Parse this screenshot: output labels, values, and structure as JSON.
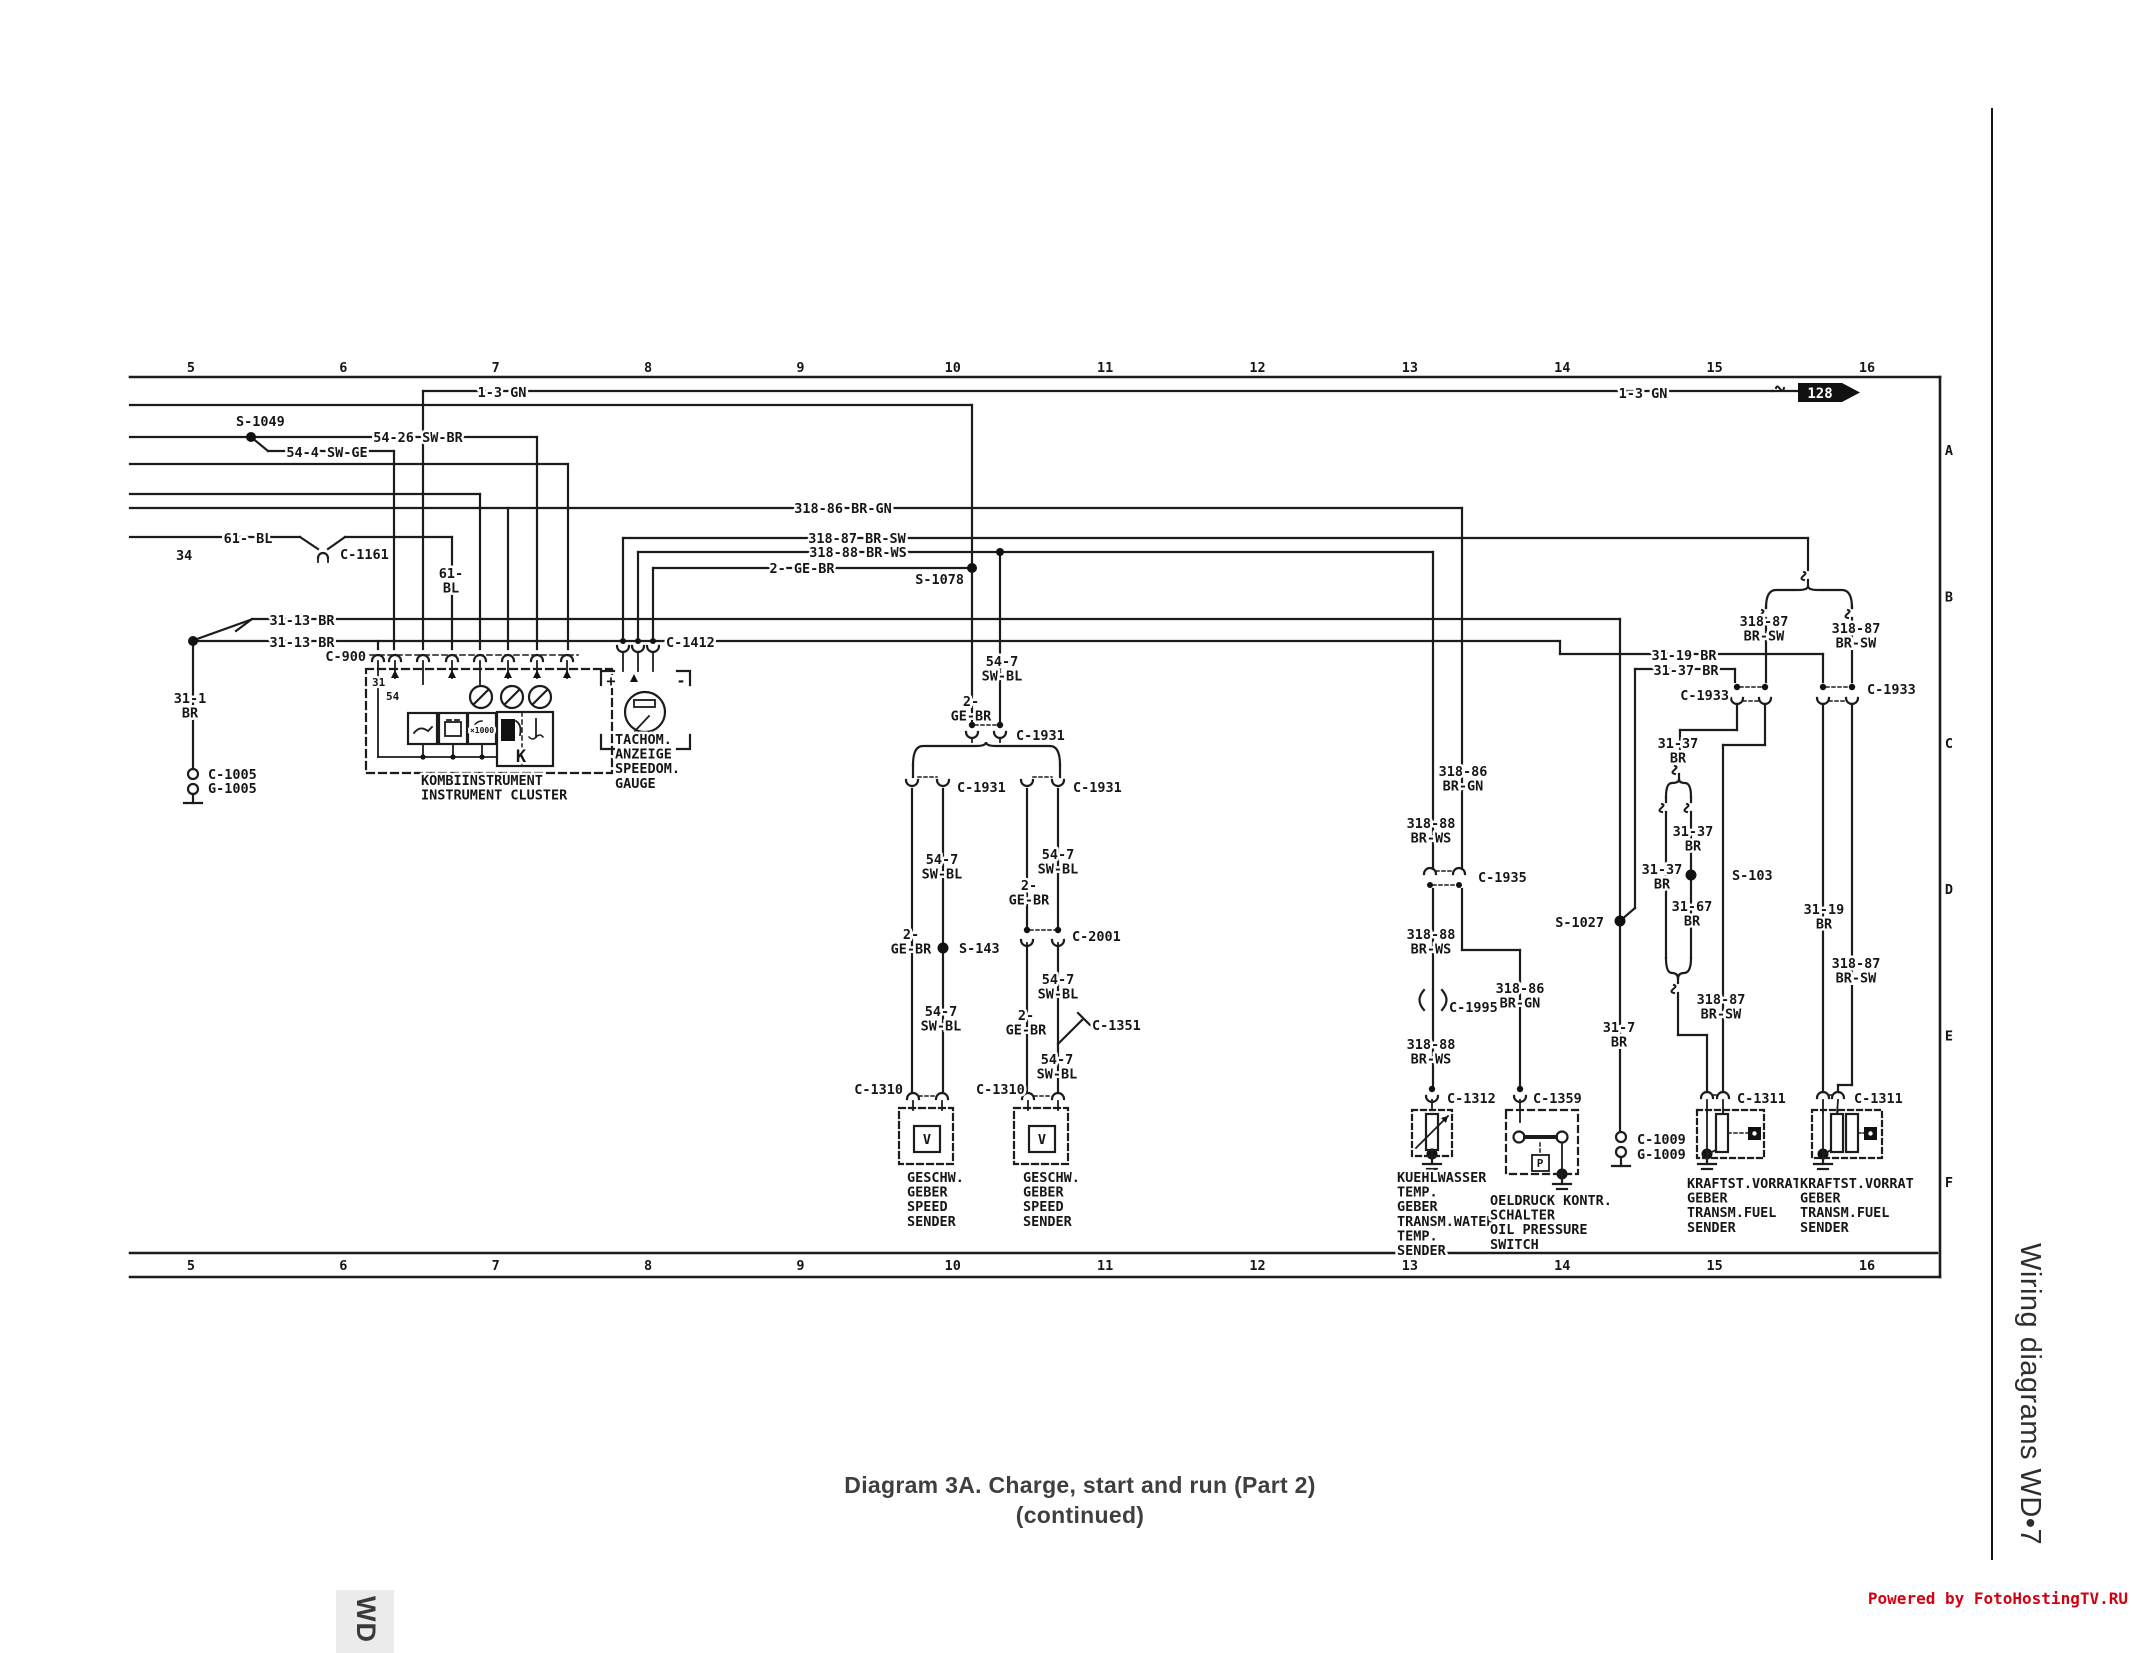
{
  "page": {
    "title_line1": "Diagram 3A. Charge, start and run (Part 2)",
    "title_line2": "(continued)",
    "sidebar_title": "Wiring diagrams  WD•7",
    "footer": "Powered by FotoHostingTV.RU",
    "corner_tab": "WD"
  },
  "ruler": {
    "numbers": [
      "5",
      "6",
      "7",
      "8",
      "9",
      "10",
      "11",
      "12",
      "13",
      "14",
      "15",
      "16"
    ],
    "letters": [
      "A",
      "B",
      "C",
      "D",
      "E",
      "F"
    ]
  },
  "diagram": {
    "arrow_ref": "128",
    "labels": [
      {
        "t": "S-1049",
        "x": 236,
        "y": 426,
        "a": "s"
      },
      {
        "t": "54-26 SW-BR",
        "x": 418,
        "y": 442,
        "a": "m"
      },
      {
        "t": "54-4 SW-GE",
        "x": 327,
        "y": 457,
        "a": "m"
      },
      {
        "t": "1-3 GN",
        "x": 502,
        "y": 397,
        "a": "m"
      },
      {
        "t": "1-3 GN",
        "x": 1643,
        "y": 398,
        "a": "m"
      },
      {
        "t": "61- BL",
        "x": 248,
        "y": 543,
        "a": "m"
      },
      {
        "t": "34",
        "x": 176,
        "y": 560,
        "a": "s"
      },
      {
        "t": "C-1161",
        "x": 340,
        "y": 559,
        "a": "s"
      },
      {
        "t": "61-\nBL",
        "x": 451,
        "y": 578,
        "a": "m"
      },
      {
        "t": "31-13 BR",
        "x": 302,
        "y": 625,
        "a": "m"
      },
      {
        "t": "31-13 BR",
        "x": 302,
        "y": 647,
        "a": "m"
      },
      {
        "t": "C-900",
        "x": 366,
        "y": 661,
        "a": "e"
      },
      {
        "t": "31",
        "x": 372,
        "y": 686,
        "a": "s",
        "fs": 11
      },
      {
        "t": "54",
        "x": 386,
        "y": 700,
        "a": "s",
        "fs": 11
      },
      {
        "t": "31-1\nBR",
        "x": 190,
        "y": 703,
        "a": "m"
      },
      {
        "t": "C-1005",
        "x": 208,
        "y": 779,
        "a": "s"
      },
      {
        "t": "G-1005",
        "x": 208,
        "y": 793,
        "a": "s"
      },
      {
        "t": "K",
        "x": 521,
        "y": 762,
        "a": "m",
        "fs": 17
      },
      {
        "t": "KOMBIINSTRUMENT\nINSTRUMENT CLUSTER",
        "x": 421,
        "y": 785,
        "a": "s"
      },
      {
        "t": "C-1412",
        "x": 666,
        "y": 647,
        "a": "s"
      },
      {
        "t": "+",
        "x": 611,
        "y": 686,
        "a": "m",
        "fs": 15
      },
      {
        "t": "-",
        "x": 681,
        "y": 686,
        "a": "m",
        "fs": 15
      },
      {
        "t": "TACHOM.\nANZEIGE\nSPEEDOM.\nGAUGE",
        "x": 615,
        "y": 744,
        "a": "s"
      },
      {
        "t": "×1000",
        "x": 482,
        "y": 733,
        "a": "m",
        "fs": 8
      },
      {
        "t": "318-86 BR-GN",
        "x": 843,
        "y": 513,
        "a": "m"
      },
      {
        "t": "318-87 BR-SW",
        "x": 857,
        "y": 543,
        "a": "m"
      },
      {
        "t": "318-88 BR-WS",
        "x": 858,
        "y": 557,
        "a": "m"
      },
      {
        "t": "2- GE-BR",
        "x": 802,
        "y": 573,
        "a": "m"
      },
      {
        "t": "S-1078",
        "x": 964,
        "y": 584,
        "a": "e"
      },
      {
        "t": "54-7\nSW-BL",
        "x": 1002,
        "y": 666,
        "a": "m"
      },
      {
        "t": "2-\nGE-BR",
        "x": 971,
        "y": 706,
        "a": "m"
      },
      {
        "t": "C-1931",
        "x": 1016,
        "y": 740,
        "a": "s"
      },
      {
        "t": "C-1931",
        "x": 957,
        "y": 792,
        "a": "s"
      },
      {
        "t": "C-1931",
        "x": 1073,
        "y": 792,
        "a": "s"
      },
      {
        "t": "54-7\nSW-BL",
        "x": 942,
        "y": 864,
        "a": "m"
      },
      {
        "t": "54-7\nSW-BL",
        "x": 1058,
        "y": 859,
        "a": "m"
      },
      {
        "t": "2-\nGE-BR",
        "x": 1029,
        "y": 890,
        "a": "m"
      },
      {
        "t": "C-2001",
        "x": 1072,
        "y": 941,
        "a": "s"
      },
      {
        "t": "2-\nGE-BR",
        "x": 911,
        "y": 939,
        "a": "m"
      },
      {
        "t": "S-143",
        "x": 959,
        "y": 953,
        "a": "s"
      },
      {
        "t": "54-7\nSW-BL",
        "x": 1058,
        "y": 984,
        "a": "m"
      },
      {
        "t": "54-7\nSW-BL",
        "x": 941,
        "y": 1016,
        "a": "m"
      },
      {
        "t": "2-\nGE-BR",
        "x": 1026,
        "y": 1020,
        "a": "m"
      },
      {
        "t": "C-1351",
        "x": 1092,
        "y": 1030,
        "a": "s"
      },
      {
        "t": "54-7\nSW-BL",
        "x": 1057,
        "y": 1064,
        "a": "m"
      },
      {
        "t": "C-1310",
        "x": 903,
        "y": 1094,
        "a": "e"
      },
      {
        "t": "C-1310",
        "x": 976,
        "y": 1094,
        "a": "s"
      },
      {
        "t": "V",
        "x": 927,
        "y": 1144,
        "a": "m"
      },
      {
        "t": "V",
        "x": 1042,
        "y": 1144,
        "a": "m"
      },
      {
        "t": "GESCHW.\nGEBER\nSPEED\nSENDER",
        "x": 907,
        "y": 1182,
        "a": "s"
      },
      {
        "t": "GESCHW.\nGEBER\nSPEED\nSENDER",
        "x": 1023,
        "y": 1182,
        "a": "s"
      },
      {
        "t": "318-86\nBR-GN",
        "x": 1463,
        "y": 776,
        "a": "m"
      },
      {
        "t": "318-88\nBR-WS",
        "x": 1431,
        "y": 828,
        "a": "m"
      },
      {
        "t": "C-1935",
        "x": 1478,
        "y": 882,
        "a": "s"
      },
      {
        "t": "318-88\nBR-WS",
        "x": 1431,
        "y": 939,
        "a": "m"
      },
      {
        "t": "C-1995",
        "x": 1449,
        "y": 1012,
        "a": "s"
      },
      {
        "t": "318-86\nBR-GN",
        "x": 1520,
        "y": 993,
        "a": "m"
      },
      {
        "t": "S-1027",
        "x": 1604,
        "y": 927,
        "a": "e"
      },
      {
        "t": "318-88\nBR-WS",
        "x": 1431,
        "y": 1049,
        "a": "m"
      },
      {
        "t": "C-1312",
        "x": 1447,
        "y": 1103,
        "a": "s"
      },
      {
        "t": "C-1359",
        "x": 1533,
        "y": 1103,
        "a": "s"
      },
      {
        "t": "P",
        "x": 1540,
        "y": 1167,
        "a": "m",
        "fs": 11
      },
      {
        "t": "KUEHLWASSER\nTEMP.\nGEBER\nTRANSM.WATER\nTEMP.\nSENDER",
        "x": 1397,
        "y": 1182,
        "a": "s"
      },
      {
        "t": "OELDRUCK KONTR.\nSCHALTER\nOIL PRESSURE\nSWITCH",
        "x": 1490,
        "y": 1205,
        "a": "s"
      },
      {
        "t": "31-7\nBR",
        "x": 1619,
        "y": 1032,
        "a": "m"
      },
      {
        "t": "C-1009",
        "x": 1637,
        "y": 1144,
        "a": "s"
      },
      {
        "t": "G-1009",
        "x": 1637,
        "y": 1159,
        "a": "s"
      },
      {
        "t": "318-87\nBR-SW",
        "x": 1764,
        "y": 626,
        "a": "m"
      },
      {
        "t": "318-87\nBR-SW",
        "x": 1856,
        "y": 633,
        "a": "m"
      },
      {
        "t": "31-19 BR",
        "x": 1684,
        "y": 660,
        "a": "m"
      },
      {
        "t": "31-37 BR",
        "x": 1686,
        "y": 675,
        "a": "m"
      },
      {
        "t": "C-1933",
        "x": 1729,
        "y": 700,
        "a": "e"
      },
      {
        "t": "C-1933",
        "x": 1867,
        "y": 694,
        "a": "s"
      },
      {
        "t": "31-37\nBR",
        "x": 1678,
        "y": 748,
        "a": "m"
      },
      {
        "t": "31-37\nBR",
        "x": 1693,
        "y": 836,
        "a": "m"
      },
      {
        "t": "31-37\nBR",
        "x": 1662,
        "y": 874,
        "a": "m"
      },
      {
        "t": "S-103",
        "x": 1732,
        "y": 880,
        "a": "s"
      },
      {
        "t": "31-67\nBR",
        "x": 1692,
        "y": 911,
        "a": "m"
      },
      {
        "t": "318-87\nBR-SW",
        "x": 1721,
        "y": 1004,
        "a": "m"
      },
      {
        "t": "31-19\nBR",
        "x": 1824,
        "y": 914,
        "a": "m"
      },
      {
        "t": "318-87\nBR-SW",
        "x": 1856,
        "y": 968,
        "a": "m"
      },
      {
        "t": "C-1311",
        "x": 1737,
        "y": 1103,
        "a": "s"
      },
      {
        "t": "C-1311",
        "x": 1854,
        "y": 1103,
        "a": "s"
      },
      {
        "t": "KRAFTST.VORRAT\nGEBER\nTRANSM.FUEL\nSENDER",
        "x": 1687,
        "y": 1188,
        "a": "s"
      },
      {
        "t": "KRAFTST.VORRAT\nGEBER\nTRANSM.FUEL\nSENDER",
        "x": 1800,
        "y": 1188,
        "a": "s"
      },
      {
        "t": "128",
        "x": 1820,
        "y": 398,
        "a": "m",
        "fs": 14,
        "fill": "#ffffff"
      }
    ]
  }
}
